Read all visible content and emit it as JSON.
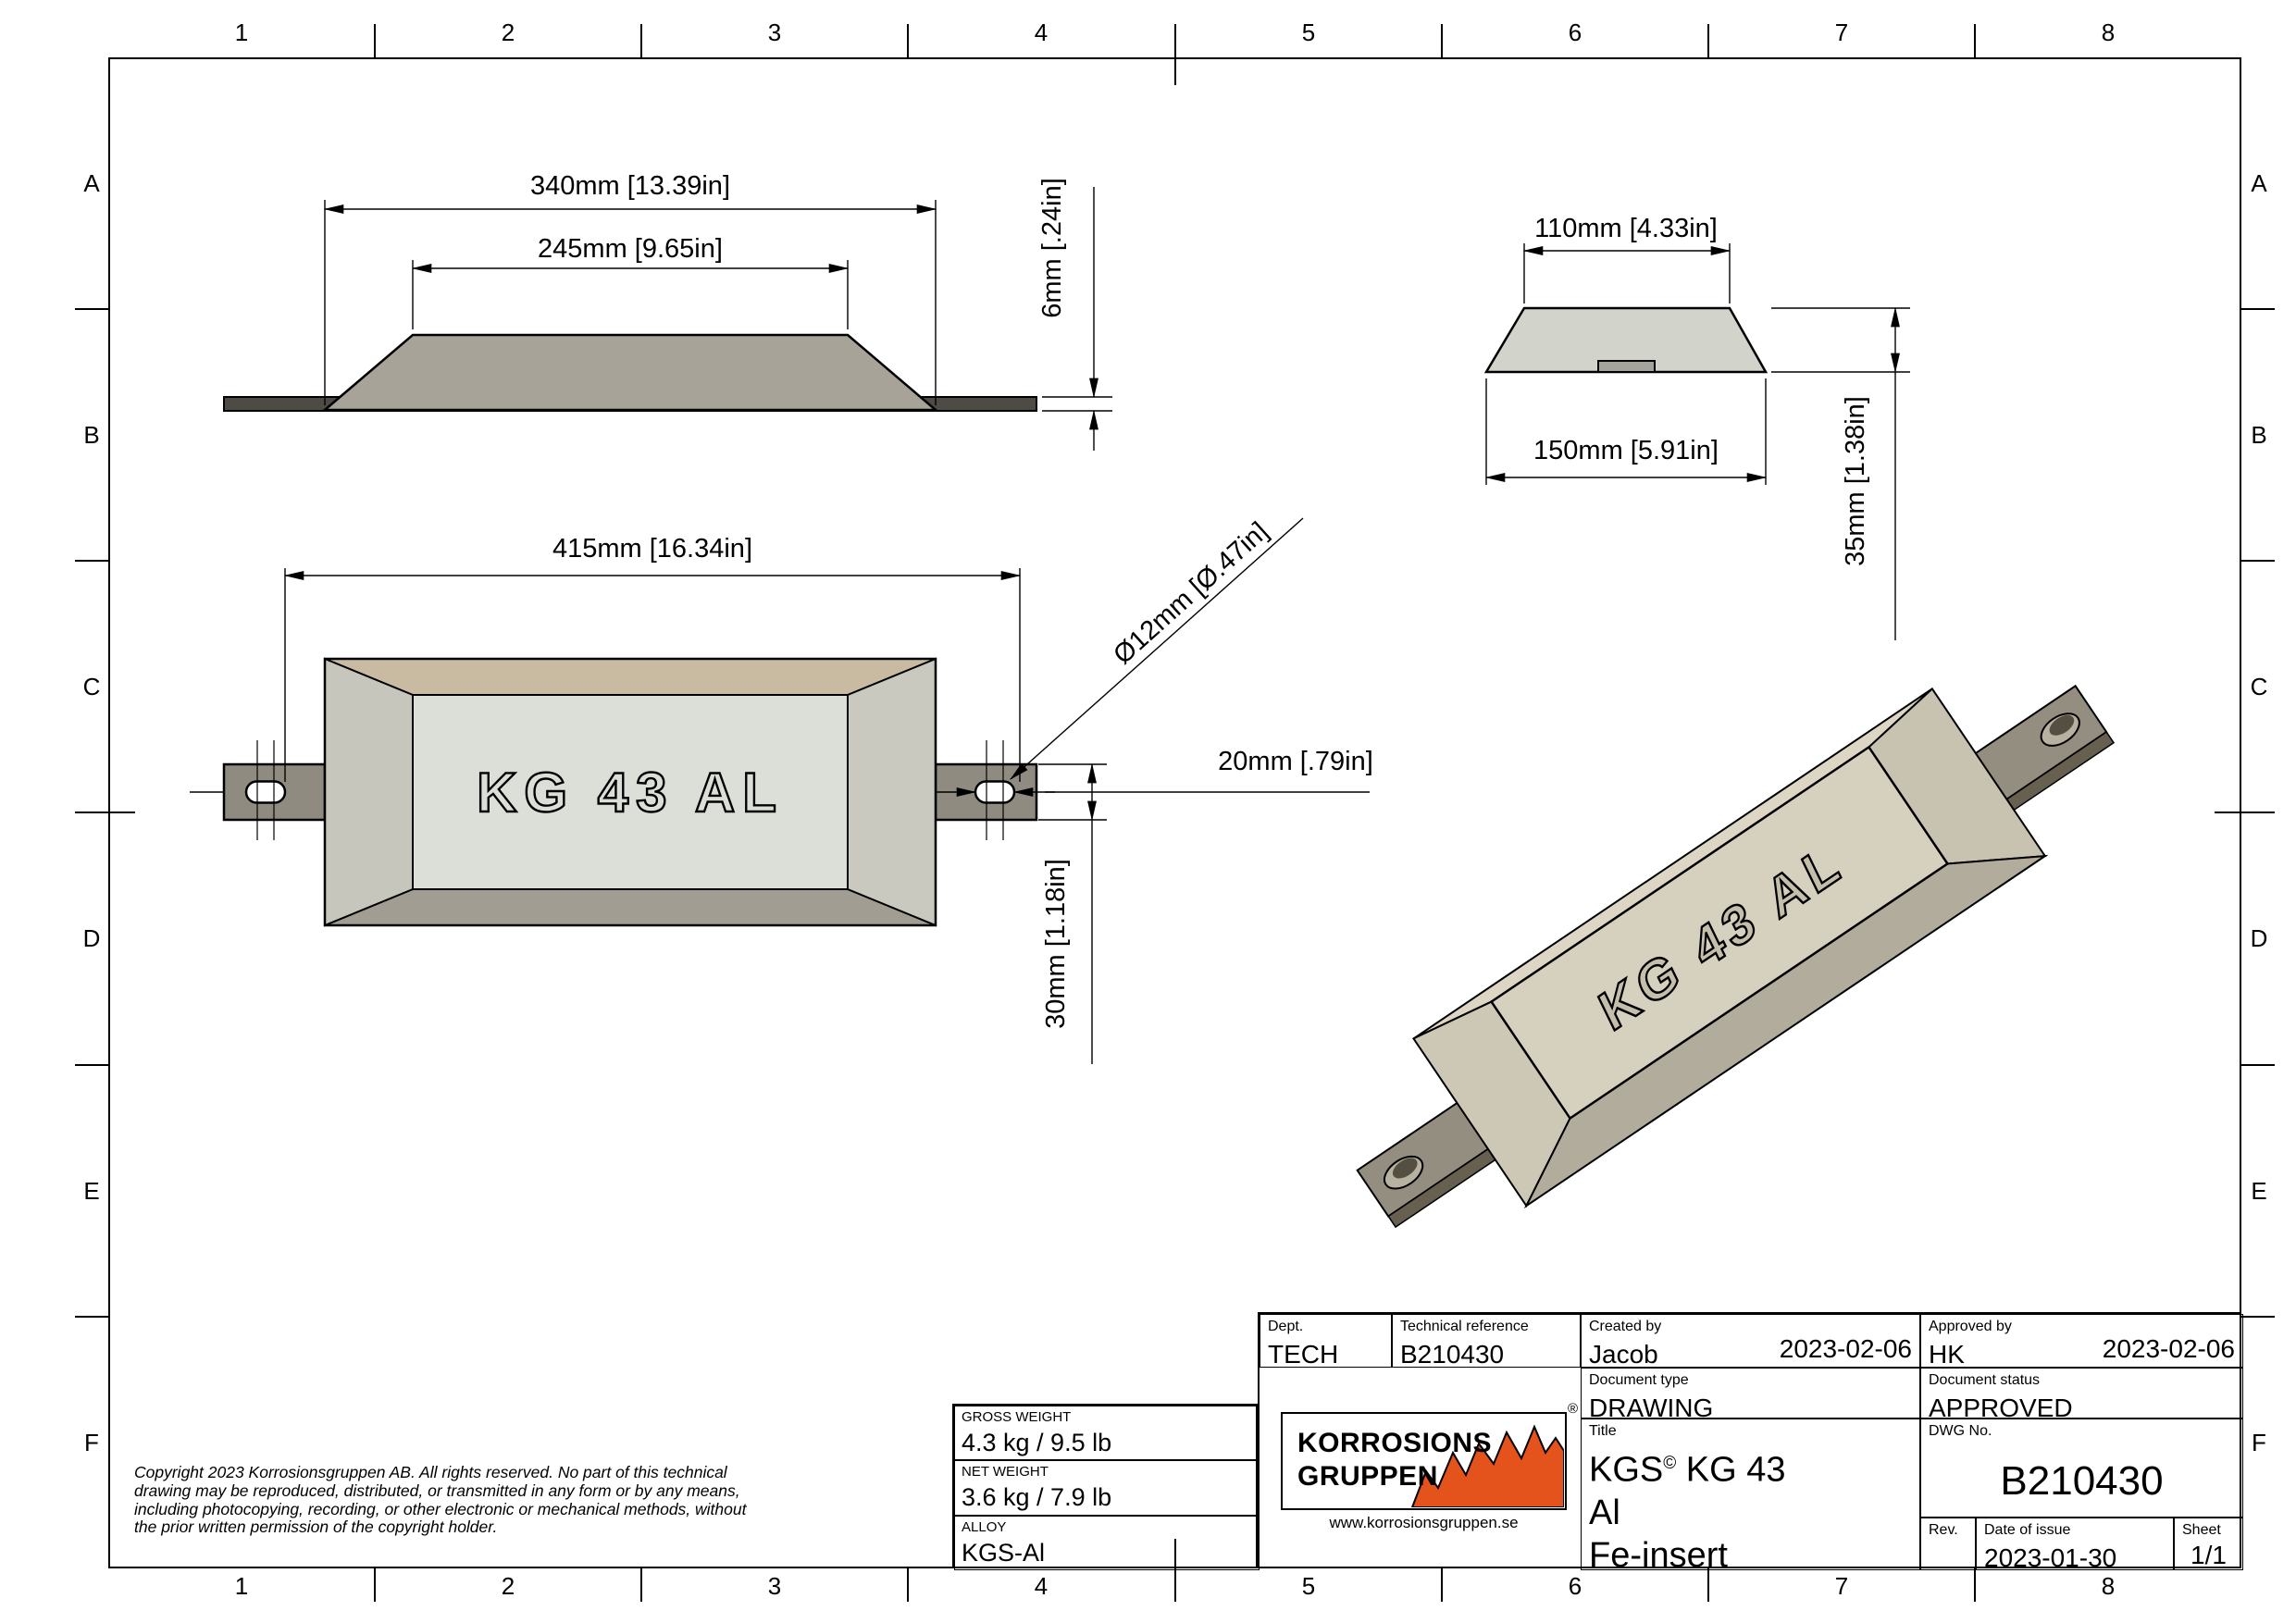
{
  "border": {
    "cols": [
      "1",
      "2",
      "3",
      "4",
      "5",
      "6",
      "7",
      "8"
    ],
    "rows": [
      "A",
      "B",
      "C",
      "D",
      "E",
      "F"
    ]
  },
  "views": {
    "side": {
      "dim_340": "340mm [13.39in]",
      "dim_245": "245mm [9.65in]",
      "dim_6": "6mm [.24in]"
    },
    "end": {
      "dim_110": "110mm [4.33in]",
      "dim_150": "150mm [5.91in]",
      "dim_35": "35mm [1.38in]"
    },
    "plan": {
      "dim_415": "415mm [16.34in]",
      "dim_d12": "Ø12mm [Ø.47in]",
      "dim_20": "20mm [.79in]",
      "dim_30": "30mm [1.18in]",
      "label": "KG 43 AL"
    },
    "iso": {
      "label": "KG 43 AL"
    }
  },
  "copyright": {
    "line1": "Copyright 2023 Korrosionsgruppen AB. All rights reserved. No part of this technical",
    "line2": "drawing may be reproduced, distributed, or transmitted in any form or by any means,",
    "line3": "including photocopying, recording, or other electronic or mechanical methods, without",
    "line4": "the prior written permission of the copyright holder."
  },
  "weight_block": {
    "gross_label": "GROSS WEIGHT",
    "gross_value": "4.3 kg / 9.5 lb",
    "net_label": "NET WEIGHT",
    "net_value": "3.6 kg / 7.9 lb",
    "alloy_label": "ALLOY",
    "alloy_value": "KGS-Al"
  },
  "title_block": {
    "dept_label": "Dept.",
    "dept_value": "TECH",
    "techref_label": "Technical reference",
    "techref_value": "B210430",
    "created_label": "Created by",
    "created_value": "Jacob",
    "created_date": "2023-02-06",
    "approved_label": "Approved by",
    "approved_value": "HK",
    "approved_date": "2023-02-06",
    "doctype_label": "Document type",
    "doctype_value": "DRAWING",
    "docstatus_label": "Document status",
    "docstatus_value": "APPROVED",
    "title_label": "Title",
    "title_line1_pre": "KGS",
    "title_line1_sup": "©",
    "title_line1_post": " KG 43",
    "title_line2": "Al",
    "title_line3": "Fe-insert",
    "dwg_label": "DWG No.",
    "dwg_value": "B210430",
    "rev_label": "Rev.",
    "rev_value": "",
    "date_label": "Date of issue",
    "date_value": "2023-01-30",
    "sheet_label": "Sheet",
    "sheet_value": "1/1",
    "logo": {
      "line1": "KORROSIONS",
      "line2": "GRUPPEN",
      "url": "www.korrosionsgruppen.se",
      "reg": "®",
      "accent": "#e4531b"
    }
  }
}
